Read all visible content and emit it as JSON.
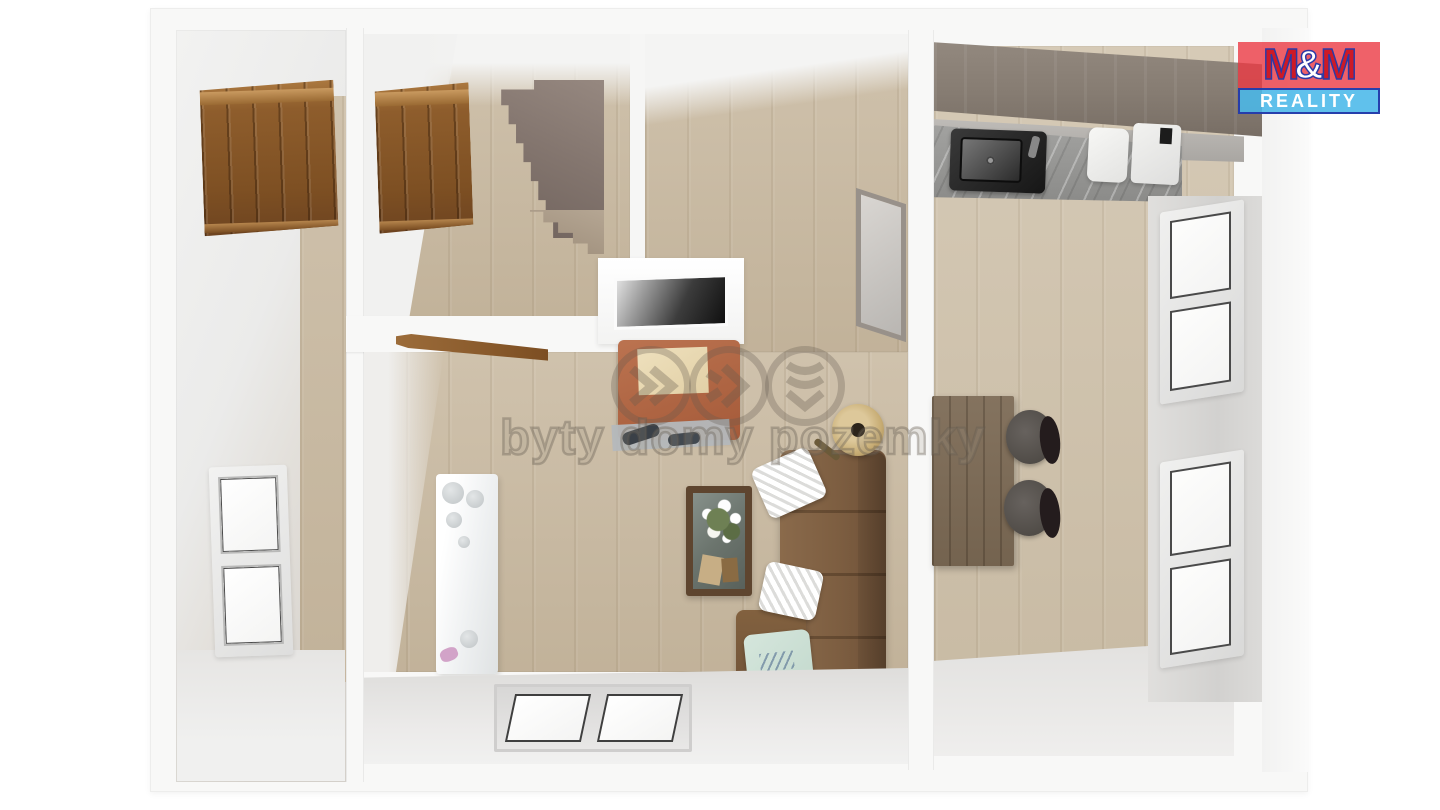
{
  "scene": {
    "type": "3d-floorplan-top-down-render",
    "rooms": [
      {
        "id": "bedroom-left",
        "furniture": [
          "wardrobe",
          "window"
        ]
      },
      {
        "id": "staircase-room",
        "furniture": [
          "wardrobe",
          "staircase"
        ]
      },
      {
        "id": "hallway",
        "furniture": [
          "glass-partition",
          "fireplace-chimney",
          "open-door"
        ]
      },
      {
        "id": "living-room",
        "furniture": [
          "armchair",
          "radiator",
          "coffee-table-with-flowers",
          "corner-sofa",
          "pillows",
          "floor-lamp",
          "double-window"
        ]
      },
      {
        "id": "kitchen-dining",
        "furniture": [
          "kitchen-cabinets",
          "countertop",
          "sink",
          "appliances",
          "dining-table",
          "two-chairs",
          "two-windows"
        ]
      }
    ]
  },
  "brand": {
    "name": "M&M REALITY",
    "m1": "M",
    "amp": "&",
    "m2": "M",
    "reality": "REALITY",
    "red_bg": "#ed3e49",
    "letter_red": "#cd1a26",
    "blue_bg": "#48b7e9",
    "border_blue": "#2031a5",
    "text_white": "#ffffff"
  },
  "watermark": {
    "text": "byty domy pozemky",
    "color": "rgba(100,91,80,0.36)",
    "icons": [
      "double-chevron-right-icon",
      "peak-arrow-icon",
      "triple-chevron-down-icon"
    ]
  },
  "palette": {
    "background": "#ffffff",
    "outer_wall": "#f8f8f7",
    "wall_face": "#ececea",
    "floor_wood": "#cabba3",
    "floor_concrete": "#e7e6e4",
    "cabinet_wood": "#8e5d2c",
    "stairs_taupe": "#84766f",
    "sofa_leather": "#7d5e41",
    "armchair_terracotta": "#a55a39",
    "coffee_table": "#5e452f",
    "dining_table": "#74634f",
    "kitchen_cabinets": "#867c72",
    "countertop_marble": "#9b9b99",
    "sink_steel": "#1f1f1f",
    "pillow_white": "#f2f2f2",
    "pillow_mint": "#cfe2d7",
    "radiator_white": "#f6f8f8",
    "window_frame": "#ececec",
    "glass": "#fbfbfa"
  }
}
